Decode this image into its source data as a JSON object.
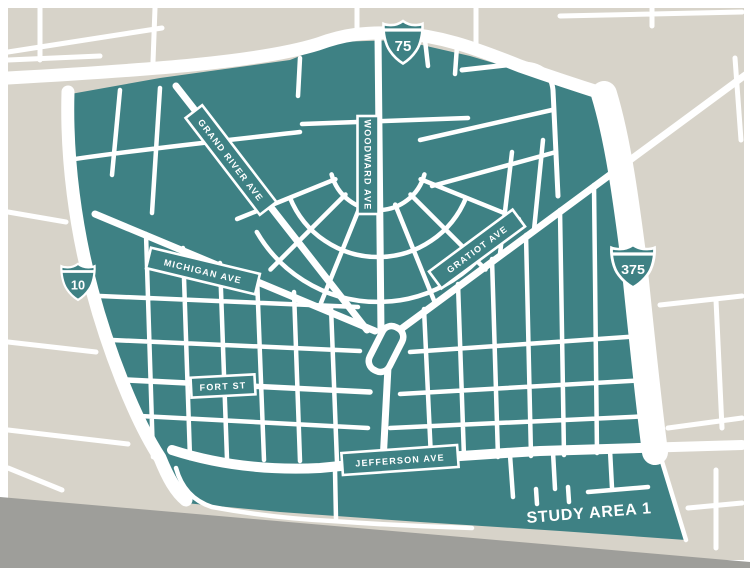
{
  "map": {
    "title": "STUDY AREA 1",
    "road_labels": {
      "grand_river": "GRAND RIVER AVE",
      "woodward": "WOODWARD AVE",
      "michigan": "MICHIGAN AVE",
      "gratiot": "GRATIOT AVE",
      "fort": "FORT ST",
      "jefferson": "JEFFERSON AVE"
    },
    "highway_shields": {
      "i75": "75",
      "m10": "10",
      "i375": "375"
    },
    "colors": {
      "study_area_teal": "#3E8184",
      "outside_gray": "#D7D3C9",
      "river_gray": "#9E9E9A",
      "street_white": "#FFFFFF"
    }
  }
}
